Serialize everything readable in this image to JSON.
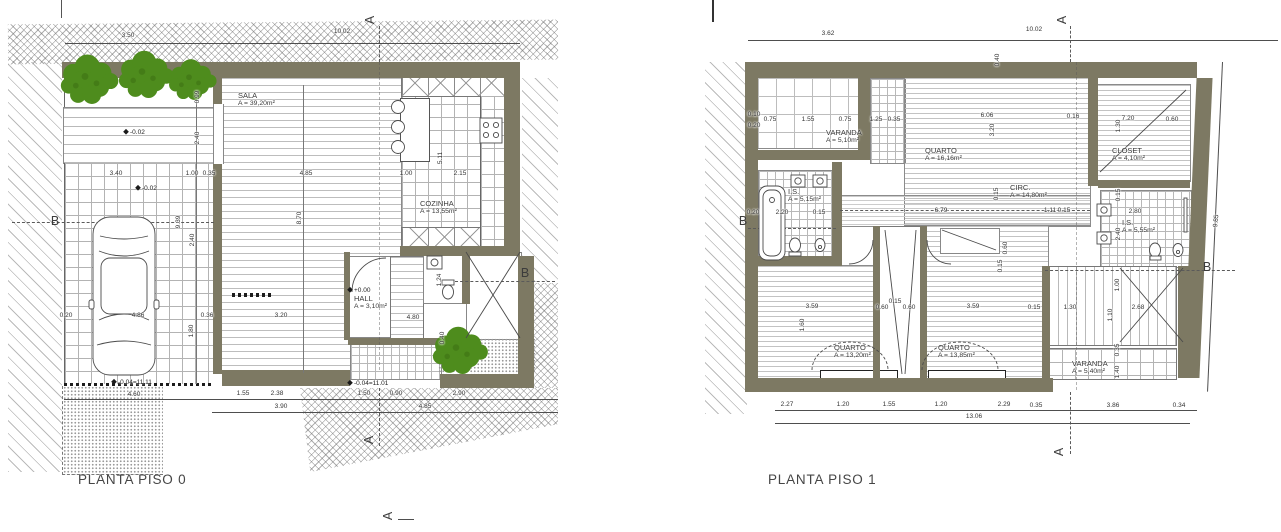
{
  "document": {
    "type": "architectural floor plans",
    "sheet_titles": [
      "PLANTA PISO 0",
      "PLANTA PISO 1"
    ]
  },
  "colors": {
    "wall": "#7d7963",
    "tree": "#4e8c1d",
    "tree_dark": "#3d7013",
    "line": "#4a4a4a",
    "dim_text": "#333333"
  },
  "piso0": {
    "title": "PLANTA PISO 0",
    "rooms": [
      {
        "name": "SALA",
        "area": "A = 39,20m²",
        "x": 238,
        "y": 100
      },
      {
        "name": "COZINHA",
        "area": "A = 13,55m²",
        "x": 420,
        "y": 208
      },
      {
        "name": "HALL",
        "area": "A = 3,10m²",
        "x": 354,
        "y": 303
      }
    ],
    "levels": [
      {
        "t": "-0.02",
        "x": 124,
        "y": 133
      },
      {
        "t": "-0.02",
        "x": 136,
        "y": 189
      },
      {
        "t": "+0.00",
        "x": 348,
        "y": 291
      },
      {
        "t": "-0.04=11.11",
        "x": 112,
        "y": 383
      },
      {
        "t": "-0.04=11.01",
        "x": 348,
        "y": 384
      }
    ],
    "dims": [
      {
        "t": "3.50",
        "x": 128,
        "y": 36
      },
      {
        "t": "10.02",
        "x": 342,
        "y": 32
      },
      {
        "t": "0.99",
        "x": 198,
        "y": 97,
        "r": -90
      },
      {
        "t": "2.40",
        "x": 198,
        "y": 138,
        "r": -90
      },
      {
        "t": "3.40",
        "x": 116,
        "y": 174
      },
      {
        "t": "1.00",
        "x": 192,
        "y": 174
      },
      {
        "t": "0.35",
        "x": 209,
        "y": 174
      },
      {
        "t": "4.85",
        "x": 306,
        "y": 174
      },
      {
        "t": "1.00",
        "x": 406,
        "y": 174
      },
      {
        "t": "2.15",
        "x": 460,
        "y": 174
      },
      {
        "t": "5.11",
        "x": 441,
        "y": 158,
        "r": -90
      },
      {
        "t": "9.39",
        "x": 179,
        "y": 222,
        "r": -90
      },
      {
        "t": "2.40",
        "x": 193,
        "y": 240,
        "r": -90
      },
      {
        "t": "8.70",
        "x": 300,
        "y": 218,
        "r": -90
      },
      {
        "t": "0.20",
        "x": 66,
        "y": 316
      },
      {
        "t": "4.86",
        "x": 138,
        "y": 316
      },
      {
        "t": "0.36",
        "x": 207,
        "y": 316
      },
      {
        "t": "3.20",
        "x": 281,
        "y": 316
      },
      {
        "t": "1.80",
        "x": 192,
        "y": 331,
        "r": -90
      },
      {
        "t": "4.80",
        "x": 413,
        "y": 318
      },
      {
        "t": "0.40",
        "x": 443,
        "y": 338,
        "r": -90
      },
      {
        "t": "1.24",
        "x": 440,
        "y": 280,
        "r": -90
      },
      {
        "t": "1.55",
        "x": 243,
        "y": 394
      },
      {
        "t": "2.38",
        "x": 277,
        "y": 394
      },
      {
        "t": "3.90",
        "x": 281,
        "y": 407
      },
      {
        "t": "1.50",
        "x": 364,
        "y": 394
      },
      {
        "t": "0.90",
        "x": 396,
        "y": 394
      },
      {
        "t": "2.90",
        "x": 459,
        "y": 394
      },
      {
        "t": "4.85",
        "x": 425,
        "y": 407
      },
      {
        "t": "4.60",
        "x": 134,
        "y": 395
      }
    ],
    "sections": [
      {
        "t": "A",
        "x": 370,
        "y": 20,
        "r": -90
      },
      {
        "t": "A",
        "x": 369,
        "y": 440,
        "r": -90
      },
      {
        "t": "A",
        "x": 388,
        "y": 516,
        "r": -90
      },
      {
        "t": "B",
        "x": 55,
        "y": 221
      },
      {
        "t": "B",
        "x": 525,
        "y": 273
      }
    ]
  },
  "piso1": {
    "title": "PLANTA PISO 1",
    "rooms": [
      {
        "name": "VARANDA",
        "area": "A = 5,10m²",
        "x": 826,
        "y": 137
      },
      {
        "name": "QUARTO",
        "area": "A = 16,16m²",
        "x": 925,
        "y": 155
      },
      {
        "name": "CLOSET",
        "area": "A = 4,10m²",
        "x": 1112,
        "y": 155
      },
      {
        "name": "CIRC.",
        "area": "A = 14,80m²",
        "x": 1010,
        "y": 192
      },
      {
        "name": "I.S.",
        "area": "A = 5,15m²",
        "x": 788,
        "y": 196
      },
      {
        "name": "I.S.",
        "area": "A = 5,55m²",
        "x": 1122,
        "y": 227
      },
      {
        "name": "QUARTO",
        "area": "A = 13,20m²",
        "x": 834,
        "y": 352
      },
      {
        "name": "QUARTO",
        "area": "A = 13,85m²",
        "x": 938,
        "y": 352
      },
      {
        "name": "VARANDA",
        "area": "A = 5,40m²",
        "x": 1072,
        "y": 368
      }
    ],
    "levels": [],
    "dims": [
      {
        "t": "3.62",
        "x": 828,
        "y": 34
      },
      {
        "t": "10.02",
        "x": 1034,
        "y": 30
      },
      {
        "t": "0.40",
        "x": 998,
        "y": 60,
        "r": -90
      },
      {
        "t": "0.10",
        "x": 754,
        "y": 115
      },
      {
        "t": "0.20",
        "x": 754,
        "y": 126
      },
      {
        "t": "0.75",
        "x": 770,
        "y": 120
      },
      {
        "t": "1.55",
        "x": 808,
        "y": 120
      },
      {
        "t": "0.75",
        "x": 845,
        "y": 120
      },
      {
        "t": "1.25",
        "x": 876,
        "y": 120
      },
      {
        "t": "0.35",
        "x": 894,
        "y": 120
      },
      {
        "t": "6.06",
        "x": 987,
        "y": 116
      },
      {
        "t": "3.20",
        "x": 993,
        "y": 130,
        "r": -90
      },
      {
        "t": "0.16",
        "x": 1073,
        "y": 117
      },
      {
        "t": "7.20",
        "x": 1128,
        "y": 119
      },
      {
        "t": "0.60",
        "x": 1172,
        "y": 120
      },
      {
        "t": "1.30",
        "x": 1119,
        "y": 126,
        "r": -90
      },
      {
        "t": "0.20",
        "x": 753,
        "y": 213
      },
      {
        "t": "2.20",
        "x": 782,
        "y": 213
      },
      {
        "t": "0.15",
        "x": 819,
        "y": 213
      },
      {
        "t": "6.79",
        "x": 941,
        "y": 211
      },
      {
        "t": "1.11",
        "x": 1050,
        "y": 211
      },
      {
        "t": "0.15",
        "x": 1064,
        "y": 211
      },
      {
        "t": "2.80",
        "x": 1135,
        "y": 212
      },
      {
        "t": "0.15",
        "x": 1119,
        "y": 195,
        "r": -90
      },
      {
        "t": "2.40",
        "x": 1119,
        "y": 234,
        "r": -90
      },
      {
        "t": "0.15",
        "x": 997,
        "y": 194,
        "r": -90
      },
      {
        "t": "0.60",
        "x": 1006,
        "y": 248,
        "r": -90
      },
      {
        "t": "0.15",
        "x": 1001,
        "y": 266,
        "r": -90
      },
      {
        "t": "0.60",
        "x": 882,
        "y": 308
      },
      {
        "t": "0.15",
        "x": 895,
        "y": 302
      },
      {
        "t": "0.60",
        "x": 909,
        "y": 308
      },
      {
        "t": "3.59",
        "x": 812,
        "y": 307
      },
      {
        "t": "3.59",
        "x": 973,
        "y": 307
      },
      {
        "t": "0.15",
        "x": 1034,
        "y": 308
      },
      {
        "t": "1.30",
        "x": 1070,
        "y": 308
      },
      {
        "t": "2.68",
        "x": 1138,
        "y": 308
      },
      {
        "t": "1.60",
        "x": 803,
        "y": 325,
        "r": -90
      },
      {
        "t": "1.00",
        "x": 1118,
        "y": 285,
        "r": -90
      },
      {
        "t": "1.10",
        "x": 1111,
        "y": 315,
        "r": -90
      },
      {
        "t": "0.35",
        "x": 1118,
        "y": 350,
        "r": -90
      },
      {
        "t": "1.40",
        "x": 1118,
        "y": 372,
        "r": -90
      },
      {
        "t": "2.27",
        "x": 787,
        "y": 405
      },
      {
        "t": "1.20",
        "x": 843,
        "y": 405
      },
      {
        "t": "1.55",
        "x": 889,
        "y": 405
      },
      {
        "t": "1.20",
        "x": 941,
        "y": 405
      },
      {
        "t": "2.29",
        "x": 1004,
        "y": 405
      },
      {
        "t": "0.35",
        "x": 1036,
        "y": 406
      },
      {
        "t": "3.86",
        "x": 1113,
        "y": 406
      },
      {
        "t": "0.34",
        "x": 1179,
        "y": 406
      },
      {
        "t": "13.06",
        "x": 974,
        "y": 417
      },
      {
        "t": "9.85",
        "x": 1217,
        "y": 221,
        "r": -84
      }
    ],
    "sections": [
      {
        "t": "A",
        "x": 1062,
        "y": 20,
        "r": -90
      },
      {
        "t": "A",
        "x": 1059,
        "y": 452,
        "r": -90
      },
      {
        "t": "B",
        "x": 743,
        "y": 221
      },
      {
        "t": "B",
        "x": 1207,
        "y": 267
      }
    ]
  }
}
